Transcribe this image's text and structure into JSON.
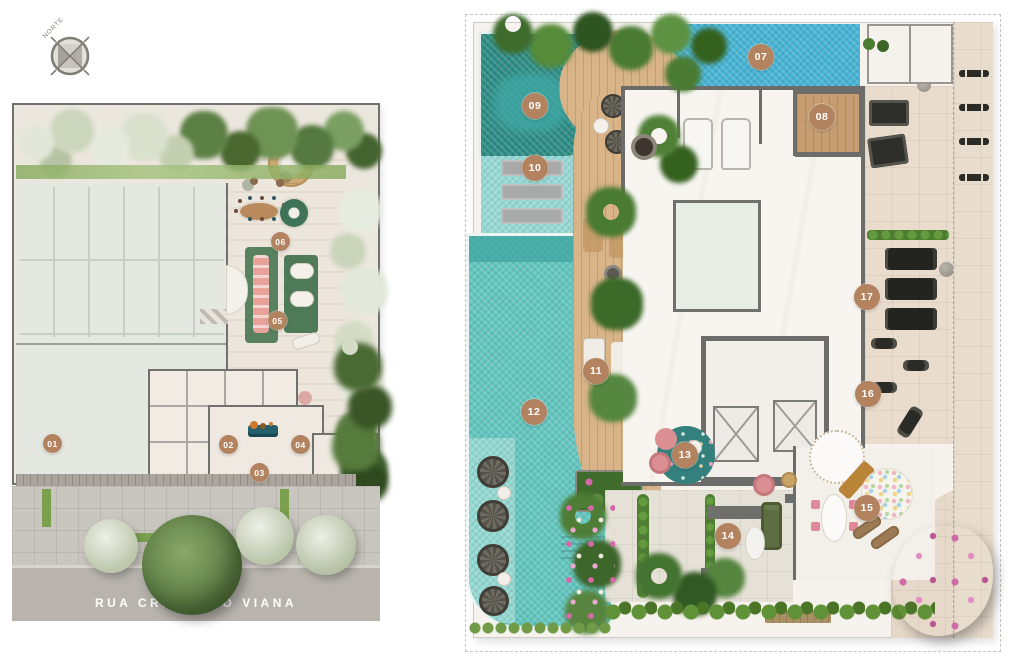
{
  "compass": {
    "label": "NORTE"
  },
  "left_plan": {
    "name": "site-plan",
    "street_name": "RUA CRISTIANO VIANA"
  },
  "right_plan": {
    "name": "rooftop-plan"
  },
  "markers": [
    {
      "label": "01",
      "x": 53,
      "y": 444,
      "plan": "site"
    },
    {
      "label": "02",
      "x": 229,
      "y": 445,
      "plan": "site"
    },
    {
      "label": "03",
      "x": 260,
      "y": 473,
      "plan": "site"
    },
    {
      "label": "04",
      "x": 301,
      "y": 445,
      "plan": "site"
    },
    {
      "label": "05",
      "x": 278,
      "y": 321,
      "plan": "site"
    },
    {
      "label": "06",
      "x": 281,
      "y": 242,
      "plan": "site"
    },
    {
      "label": "07",
      "x": 761,
      "y": 57,
      "plan": "rooftop"
    },
    {
      "label": "08",
      "x": 822,
      "y": 117,
      "plan": "rooftop"
    },
    {
      "label": "09",
      "x": 535,
      "y": 106,
      "plan": "rooftop"
    },
    {
      "label": "10",
      "x": 535,
      "y": 168,
      "plan": "rooftop"
    },
    {
      "label": "11",
      "x": 596,
      "y": 371,
      "plan": "rooftop"
    },
    {
      "label": "12",
      "x": 534,
      "y": 412,
      "plan": "rooftop"
    },
    {
      "label": "13",
      "x": 685,
      "y": 455,
      "plan": "rooftop"
    },
    {
      "label": "14",
      "x": 728,
      "y": 536,
      "plan": "rooftop"
    },
    {
      "label": "15",
      "x": 867,
      "y": 508,
      "plan": "rooftop"
    },
    {
      "label": "16",
      "x": 868,
      "y": 394,
      "plan": "rooftop"
    },
    {
      "label": "17",
      "x": 867,
      "y": 297,
      "plan": "rooftop"
    }
  ],
  "colors": {
    "marker_bg": "#b3835f",
    "marker_text": "#ffffff",
    "street_bg": "#b8b4ad",
    "street_text": "#ffffff",
    "wall_gray": "#6c6c6a",
    "pool_blue": "#47b4d4",
    "pool_teal": "#63c6bf",
    "pool_dark": "#2e8d85",
    "deck_wood": "#d8b488",
    "marble": "#f8f5f1",
    "tile": "#e9dccd",
    "garage": "#e4e8e1",
    "sidewalk": "#c9c6bf",
    "grass": "#7fa857"
  }
}
